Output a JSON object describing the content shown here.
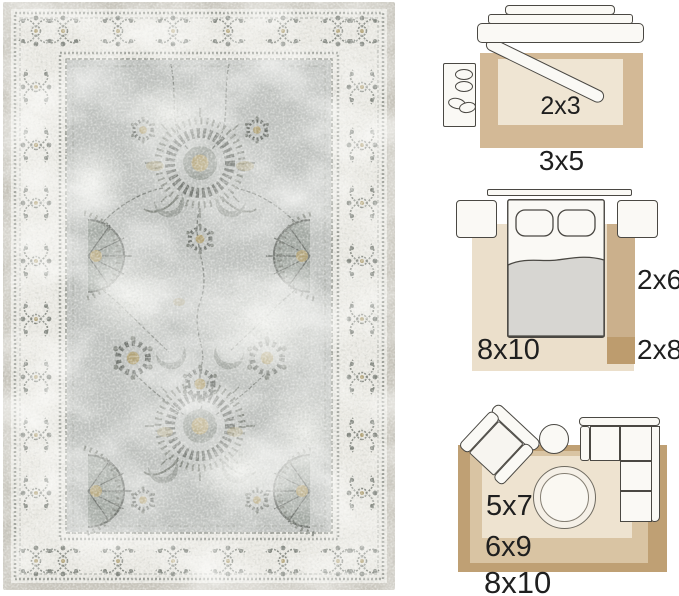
{
  "colors": {
    "canvas-bg": "#ffffff",
    "label-text": "#1f1f1f",
    "outline": "#4a4843",
    "furniture-fill": "#faf9f5",
    "blanket": "#d7d6d2",
    "entry-rug-large": "#d3b996",
    "entry-rug-small": "#efe5d3",
    "bedroom-rug": "#ebdfcb",
    "bedroom-runner": "#cbb08c",
    "bedroom-runner-long": "#bd9c6e",
    "living-rug-large": "#bfa074",
    "living-rug-medium": "#d9c4a3",
    "living-rug-small": "#eee3d0",
    "rug-binding": "#c8c5bc",
    "rug-border-bg": "#e9e8e2",
    "rug-field": "#bfc2bf",
    "rug-motif": "#82867f",
    "rug-motif-dark": "#6e726d",
    "rug-gold": "#b2a378"
  },
  "size_guide": {
    "entryway": {
      "small_rug": "2x3",
      "large_rug": "3x5"
    },
    "bedroom": {
      "area_rug": "8x10",
      "runner": "2x6",
      "long_runner": "2x8"
    },
    "living_room": {
      "small_rug": "5x7",
      "medium_rug": "6x9",
      "large_rug": "8x10"
    }
  }
}
